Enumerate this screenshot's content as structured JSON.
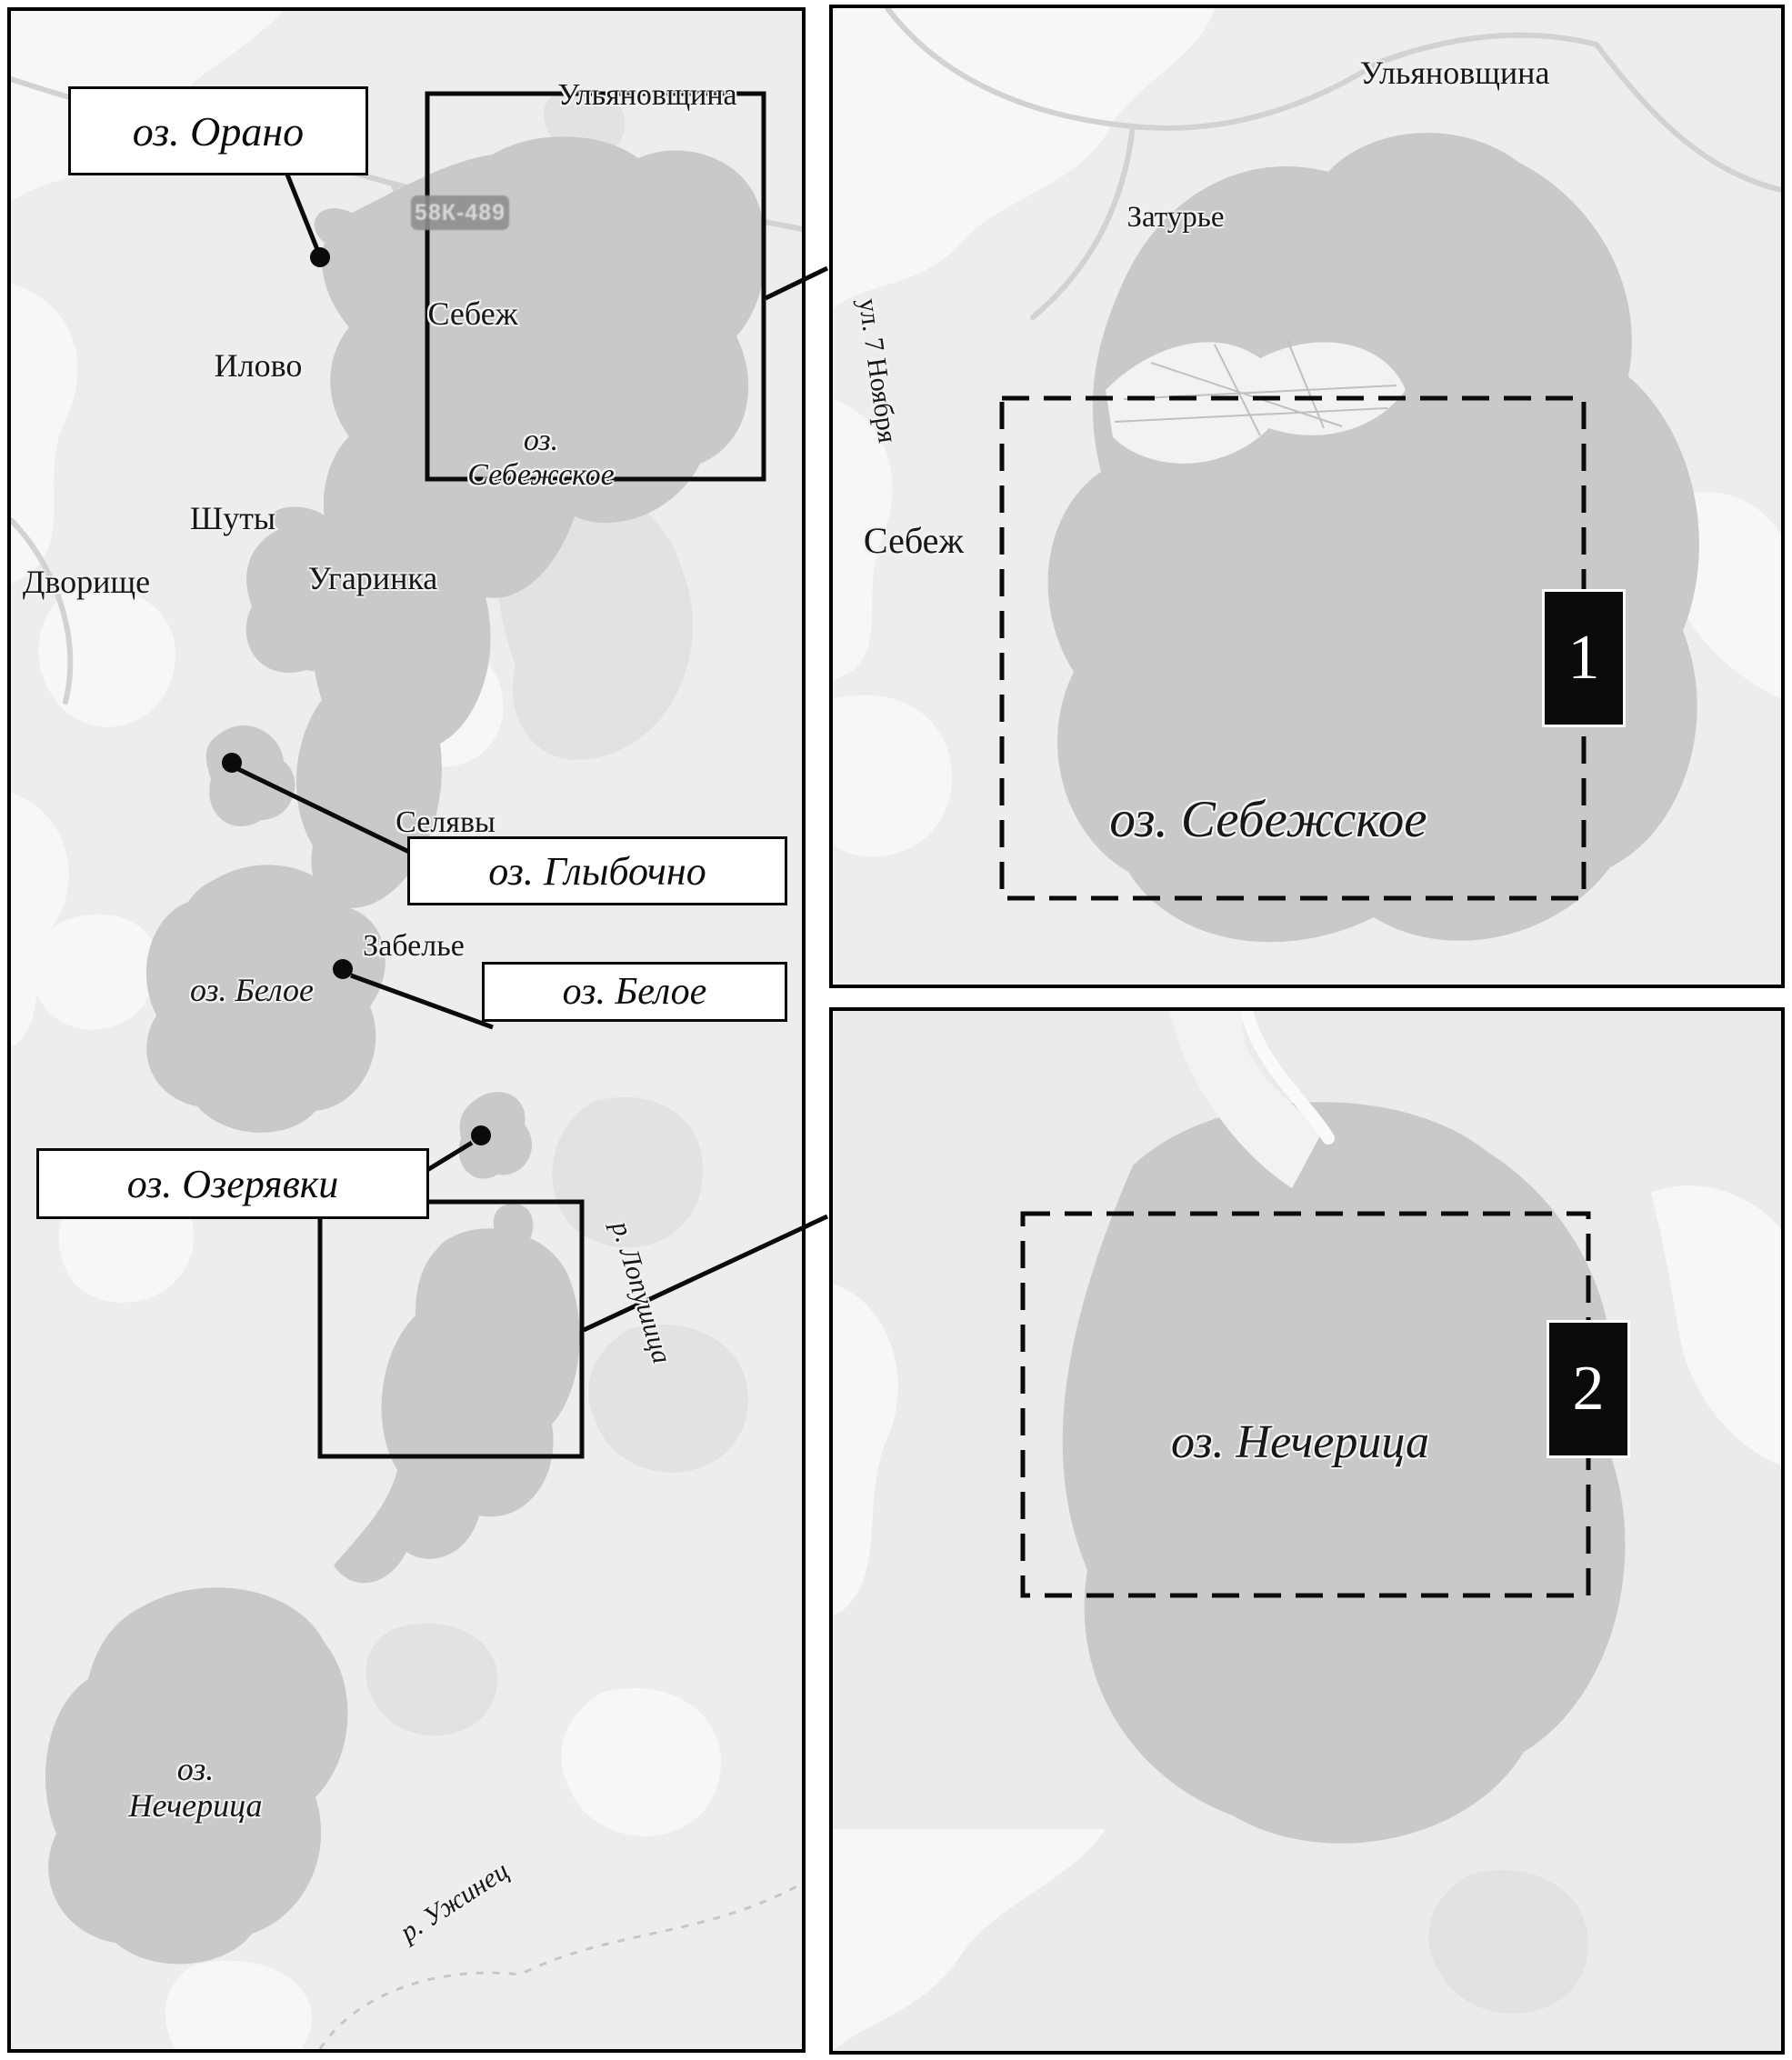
{
  "left_map": {
    "places": {
      "ulyanovschina": "Ульяновщина",
      "sebezh": "Себеж",
      "ilovo": "Илово",
      "shuty": "Шуты",
      "dvorishche": "Дворище",
      "ugarinka": "Угаринка",
      "selyavy": "Селявы",
      "zabelye": "Забелье"
    },
    "callout_boxes": {
      "orano": "оз. Орано",
      "glybochno": "оз. Глыбочно",
      "beloye": "оз. Белое",
      "ozeryavki": "оз. Озерявки"
    },
    "lake_labels": {
      "sebezhskoye_line1": "оз.",
      "sebezhskoye_line2": "Себежское",
      "beloye": "оз. Белое",
      "necheritsa_line1": "оз.",
      "necheritsa_line2": "Нечерица"
    },
    "rivers": {
      "lopushitsa": "р. Лопушица",
      "uzhinets": "р. Ужинец"
    },
    "road_badge": "58К-489"
  },
  "inset_sebezhskoye": {
    "marker": "1",
    "lake_label": "оз. Себежское",
    "places": {
      "ulyanovschina": "Ульяновщина",
      "zaturye": "Затурье",
      "sebezh": "Себеж"
    },
    "street": "ул. 7 Ноября"
  },
  "inset_necheritsa": {
    "marker": "2",
    "lake_label": "оз. Нечерица"
  },
  "colors": {
    "map_bg": "#ededed",
    "lake": "#c9c9c9",
    "light_patch": "#f7f7f7",
    "dark_patch": "#e2e2e2",
    "marker_bg": "#0b0b0b",
    "marker_text": "#ffffff",
    "road_badge_bg": "#8f8f8f",
    "road_badge_text": "#d9d9d9"
  }
}
